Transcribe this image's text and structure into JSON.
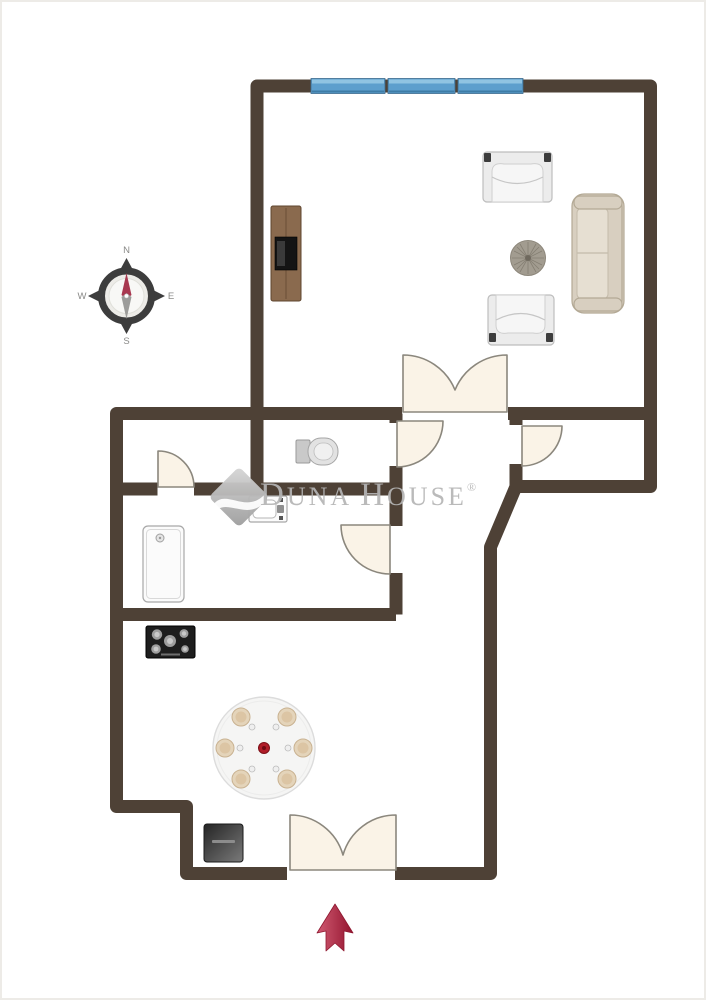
{
  "title": "apartment-floor-plan",
  "watermark": {
    "part1": "D",
    "part2": "UNA",
    "part3": "H",
    "part4": "OUSE",
    "registered": "®"
  },
  "compass": {
    "n": "N",
    "e": "E",
    "s": "S",
    "w": "W"
  },
  "colors": {
    "wall": "#4E4136",
    "window_blue": "#5D9FCD",
    "window_highlight": "#90C4E2",
    "door_fill": "#FAF3E7",
    "door_stroke": "#8B877D",
    "watermark_gray": "#B5B5B5",
    "arrow_red": "#BE2A44",
    "compass_needle_red": "#A83850",
    "sofa_beige": "#D8CFC0",
    "wood_brown": "#8A6A4E",
    "table_plate": "#E4D4BA"
  },
  "icons": {
    "compass_rose": "circular compass with N/E/S/W tips and red north needle",
    "entrance_arrow": "red upward arrow marking the entrance",
    "watermark_logo": "gray rotated diamond with white wave swoosh",
    "window": "blue triple-pane strip in top wall",
    "double_door": "butterfly double swing arcs",
    "single_door": "quarter-circle swing arc",
    "tv_cabinet": "wooden media unit with black TV",
    "armchair": "upholstered armchair top view",
    "pouf": "round tufted ottoman",
    "sofa": "three-seat sofa top view",
    "toilet": "toilet with tank, top view",
    "washbasin": "basin with taps",
    "shower_tray": "shower tray with drain",
    "cooktop": "black hob with five burners",
    "dining_table": "round table with six place settings",
    "appliance": "dark floor unit near entrance"
  }
}
